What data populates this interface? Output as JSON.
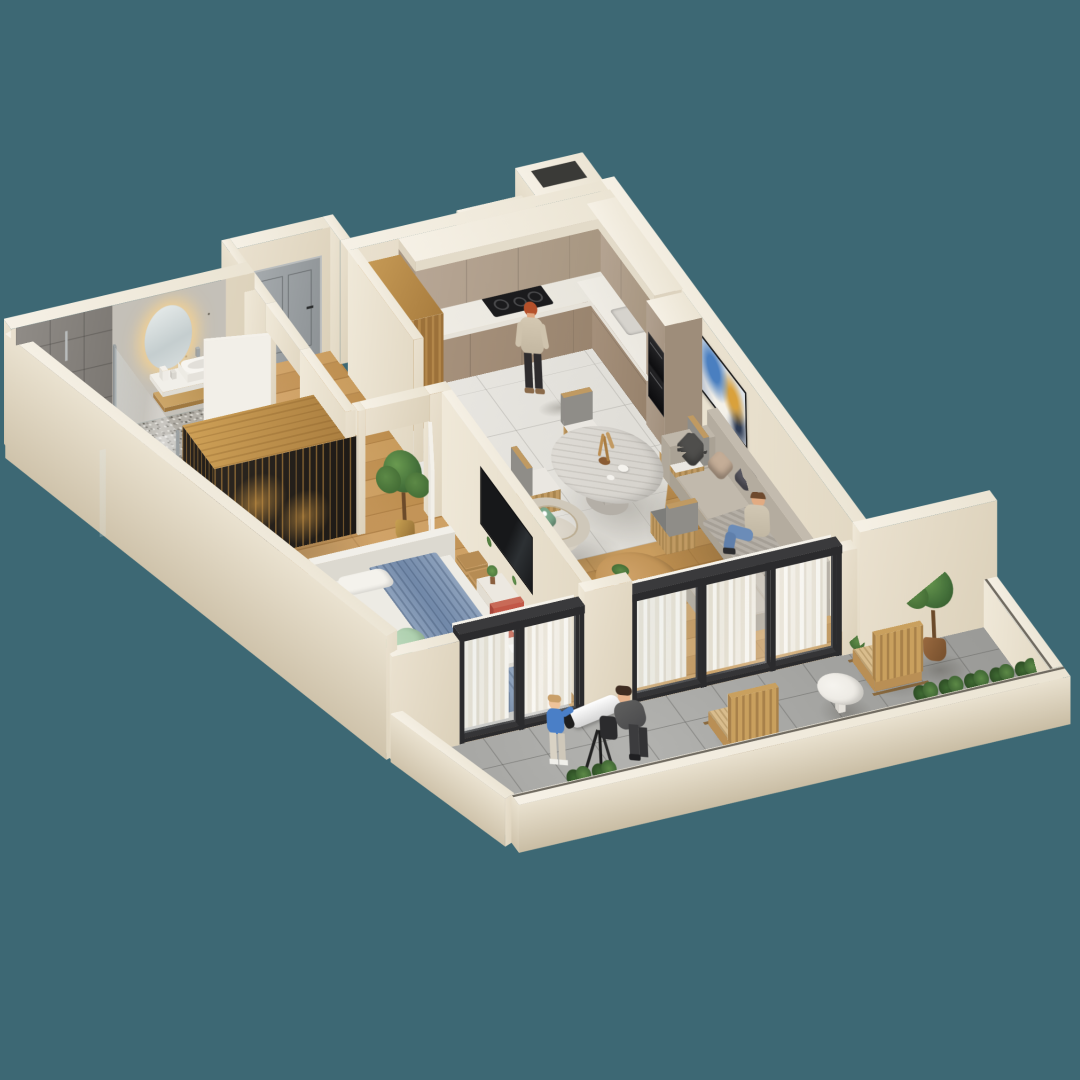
{
  "scene": {
    "title": "3D isometric cutaway apartment floor plan render",
    "background_color": "#3d6874",
    "projection": "axonometric cutaway, viewed from south-west above"
  },
  "palette": {
    "background": "#3d6874",
    "walls_cream": "#e7decc",
    "wall_tops": "#f3eee2",
    "wood_floor": "#cf9e62",
    "kitchen_marble_floor": "#e8e6e1",
    "balcony_tiles": "#a7a7a4",
    "terrazzo": "#b5b1a9",
    "grey_tile": "#86827d",
    "cabinet_taupe": "#b2a190",
    "gold_wood": "#c0954e",
    "accent_blue": "#7792bb",
    "bed_blanket_blue": "#8097b6",
    "accent_red_chair": "#c25847",
    "accent_green_pillow": "#7ca98c",
    "door_frame_black": "#2b2b2d",
    "entrance_door_grey": "#9aa0a3"
  },
  "rooms": [
    {
      "name": "bathroom",
      "items": [
        "walk-in shower with glass partition",
        "white floor towel",
        "oval LED backlit mirror",
        "white vanity sink",
        "wood shelf",
        "grey stone tile wall",
        "terrazzo mosaic wall",
        "white swing door",
        "slatted gold-wood wardrobe divider"
      ]
    },
    {
      "name": "hallway",
      "items": [
        "recessed grey entrance door",
        "white bedroom door",
        "wood floor"
      ]
    },
    {
      "name": "kitchen",
      "items": [
        "L-shaped taupe cabinets",
        "marble backsplash with under-cabinet light",
        "black cooktop",
        "built-in black double oven",
        "sink",
        "tall fluted-glass pantry cabinet",
        "round pale dining table",
        "four wood dining chairs",
        "dried pampas vase",
        "teapot and cup"
      ]
    },
    {
      "name": "living-room",
      "items": [
        "grey corner sofa with chaise",
        "dark grey pillows",
        "tan pillow",
        "striped pillow",
        "grey throw",
        "round wood coffee table",
        "barrel armchair",
        "green leaf pillow",
        "abstract blue-gold wall art"
      ]
    },
    {
      "name": "bedroom",
      "items": [
        "double bed with white duvet",
        "blue blanket",
        "mint pillow",
        "white headboard",
        "grey area rug",
        "wall TV on partition",
        "white media console",
        "wicker baskets",
        "white desk",
        "red chair",
        "potted tree"
      ]
    },
    {
      "name": "balcony",
      "items": [
        "grey tile floor",
        "two wood rocking chairs",
        "blue cushions",
        "white round side table",
        "white telescope on tripod",
        "planter boxes with greenery",
        "potted tree",
        "black-framed glass doors with white curtains",
        "low parapet walls"
      ]
    }
  ],
  "people": [
    {
      "name": "woman-cooking",
      "location": "kitchen",
      "appearance": "red hair, beige top, black leggings"
    },
    {
      "name": "man-sitting",
      "location": "living-room sofa",
      "appearance": "beige hoodie, blue jeans"
    },
    {
      "name": "woman-at-telescope",
      "location": "balcony",
      "appearance": "dark hair, grey jacket"
    },
    {
      "name": "child",
      "location": "balcony",
      "appearance": "blue shirt, light pants"
    }
  ]
}
